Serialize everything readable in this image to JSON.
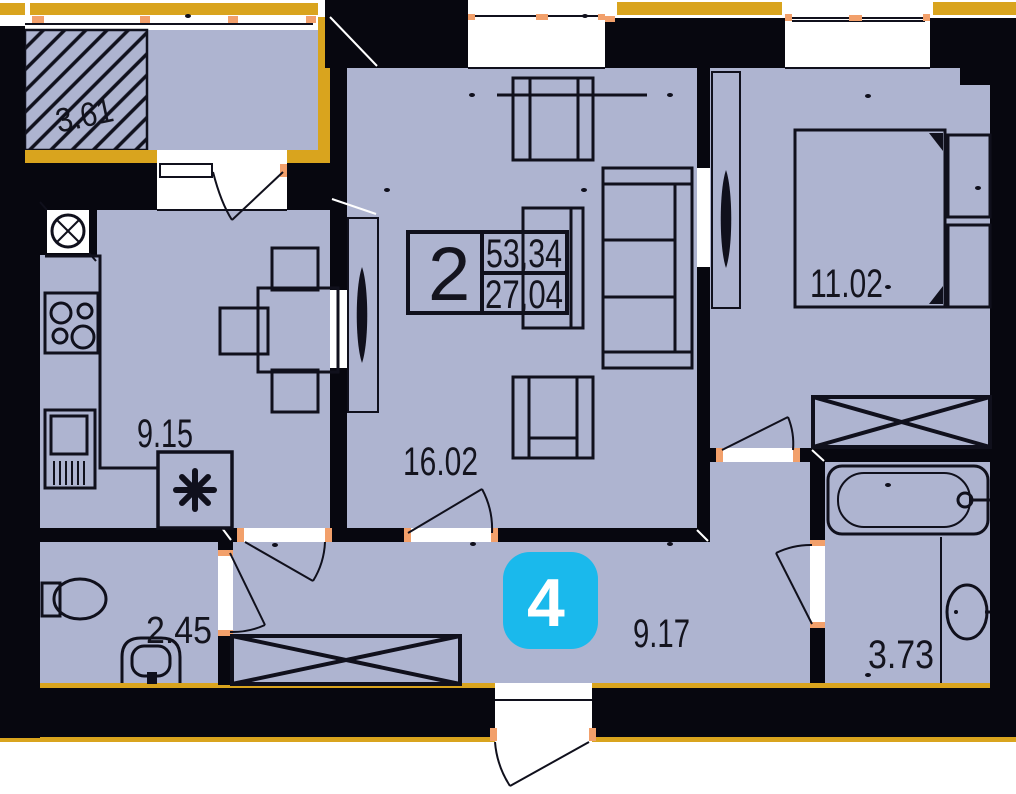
{
  "plan": {
    "unit_card": {
      "number": "2",
      "total_area": "53,34",
      "living_area": "27,04"
    },
    "unit_badge": {
      "number": "4"
    },
    "rooms": [
      {
        "name": "balcony",
        "area": "3.61"
      },
      {
        "name": "kitchen",
        "area": "9.15"
      },
      {
        "name": "living-room",
        "area": "16.02"
      },
      {
        "name": "bedroom",
        "area": "11.02"
      },
      {
        "name": "wc",
        "area": "2.45"
      },
      {
        "name": "hallway",
        "area": "9.17"
      },
      {
        "name": "bathroom",
        "area": "3.73"
      }
    ],
    "colors": {
      "floor": "#aeb4d0",
      "wall": "#07070f",
      "facade_accent": "#d9a41e",
      "door_jamb": "#f2a06b",
      "badge_accent": "#1ab9ec",
      "background": "#ffffff"
    },
    "icons": [
      "ventilation-icon",
      "appliance-asterisk-icon"
    ]
  }
}
